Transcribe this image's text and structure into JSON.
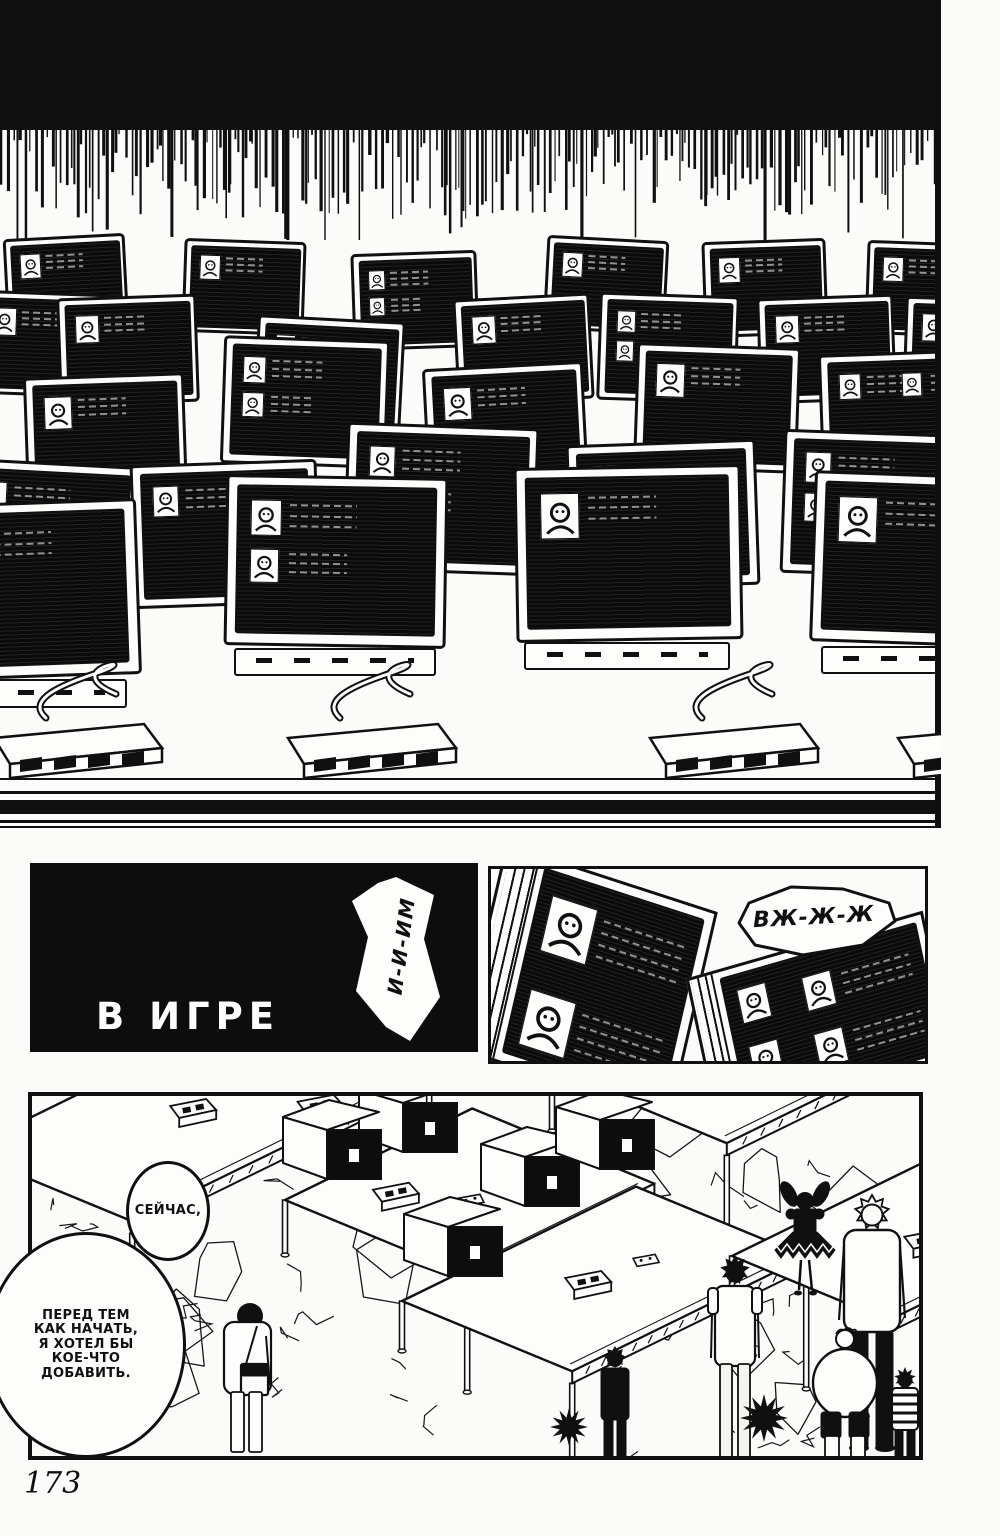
{
  "page": {
    "number": "173",
    "paper": "#fbfbf9",
    "ink": "#101010"
  },
  "texts": {
    "caption": "В ИГРЕ",
    "sfx_vertical": "И-И-ИМ",
    "sfx_whirr": "ВЖ-Ж-Ж",
    "bubble_now": "СЕЙЧАС,",
    "bubble_before_lines": [
      "ПЕРЕД ТЕМ",
      "КАК НАЧАТЬ,",
      "Я ХОТЕЛ БЫ",
      "КОЕ-ЧТО",
      "ДОБАВИТЬ."
    ]
  },
  "artwork": {
    "speedlines": {
      "width": 941,
      "solid_height": 130,
      "seed": 7
    },
    "wall": {
      "width": 941,
      "height": 835,
      "monitor_w": 218,
      "monitor_h": 168,
      "monitors": [
        [
          5,
          236,
          0.56,
          -3,
          1
        ],
        [
          183,
          240,
          0.56,
          2,
          1
        ],
        [
          352,
          252,
          0.58,
          -2,
          2
        ],
        [
          545,
          238,
          0.56,
          3,
          1
        ],
        [
          703,
          240,
          0.57,
          -2,
          1
        ],
        [
          866,
          242,
          0.56,
          2,
          1
        ],
        [
          -25,
          292,
          0.62,
          2,
          1
        ],
        [
          58,
          296,
          0.64,
          -2,
          1
        ],
        [
          255,
          318,
          0.68,
          3,
          2
        ],
        [
          455,
          296,
          0.63,
          -3,
          1
        ],
        [
          598,
          294,
          0.64,
          2,
          2
        ],
        [
          758,
          296,
          0.63,
          -2,
          1
        ],
        [
          904,
          298,
          0.62,
          2,
          1
        ],
        [
          25,
          375,
          0.74,
          -2,
          1
        ],
        [
          222,
          338,
          0.76,
          2,
          2
        ],
        [
          425,
          365,
          0.74,
          -3,
          1
        ],
        [
          635,
          345,
          0.75,
          2,
          1
        ],
        [
          820,
          352,
          0.74,
          -2,
          2
        ],
        [
          -50,
          462,
          0.86,
          3,
          1
        ],
        [
          132,
          462,
          0.86,
          -2,
          2
        ],
        [
          345,
          425,
          0.88,
          2,
          2
        ],
        [
          568,
          442,
          0.87,
          -2,
          1
        ],
        [
          782,
          432,
          0.86,
          2,
          2
        ],
        [
          -90,
          502,
          1.05,
          -2,
          1
        ],
        [
          225,
          476,
          1.02,
          1,
          2
        ],
        [
          515,
          466,
          1.04,
          -1,
          1
        ],
        [
          812,
          474,
          1.02,
          2,
          1
        ]
      ],
      "front_start": 23,
      "switch_boxes": [
        -6,
        288,
        650,
        898
      ],
      "edge_lines": [
        [
          778,
          2
        ],
        [
          791,
          3
        ],
        [
          800,
          14
        ],
        [
          820,
          3
        ],
        [
          826,
          2
        ]
      ],
      "right_rule": {
        "x": 935,
        "w": 6,
        "h": 828
      }
    },
    "panels": {
      "title": {
        "x": 30,
        "y": 863,
        "w": 448,
        "h": 189
      },
      "closeup": {
        "x": 488,
        "y": 866,
        "w": 440,
        "h": 198
      },
      "hall": {
        "x": 28,
        "y": 1092,
        "w": 895,
        "h": 368,
        "border": 4
      }
    },
    "hall": {
      "seed": 11,
      "cracks": 58,
      "stones": 16,
      "u": [
        0.9,
        -0.44
      ],
      "v": [
        0.92,
        0.38
      ],
      "tables": [
        {
          "o": [
            -70,
            55
          ],
          "L": 330,
          "S": 185,
          "legs": [
            60,
            115,
            140
          ],
          "items": [
            [
              "con",
              170,
              60
            ],
            [
              "pad",
              235,
              40
            ],
            [
              "con",
              240,
              130
            ]
          ]
        },
        {
          "o": [
            520,
            -25
          ],
          "L": 300,
          "S": 190,
          "legs": [
            60,
            130,
            150
          ],
          "items": [
            [
              "con",
              140,
              80
            ],
            [
              "pad",
              200,
              60
            ]
          ]
        },
        {
          "o": [
            253,
            104
          ],
          "L": 208,
          "S": 198,
          "legs": [
            55,
            105,
            125
          ],
          "items": [
            [
              "con",
              66,
              31
            ],
            [
              "pad",
              95,
              95
            ]
          ]
        },
        {
          "o": [
            370,
            205
          ],
          "L": 260,
          "S": 185,
          "legs": [
            50,
            100,
            120
          ],
          "items": [
            [
              "con",
              120,
              60
            ],
            [
              "pad",
              175,
              80
            ]
          ]
        },
        {
          "o": [
            700,
            160
          ],
          "L": 240,
          "S": 170,
          "legs": [
            45,
            95,
            115
          ],
          "items": [
            [
              "con",
              120,
              70
            ]
          ]
        }
      ],
      "monitors": [
        [
          327,
          -6
        ],
        [
          251,
          21
        ],
        [
          449,
          48
        ],
        [
          524,
          11
        ],
        [
          372,
          118
        ]
      ],
      "people": [
        {
          "type": "girl",
          "x": 773,
          "feet": 200,
          "h": 112
        },
        {
          "type": "tallman",
          "x": 840,
          "feet": 354,
          "h": 250
        },
        {
          "type": "boy",
          "x": 703,
          "feet": 366,
          "h": 204
        },
        {
          "type": "darkkid",
          "x": 583,
          "feet": 366,
          "h": 114
        },
        {
          "type": "walker",
          "x": 216,
          "feet": 356,
          "h": 150
        },
        {
          "type": "heavykid",
          "x": 813,
          "feet": 366,
          "h": 134
        },
        {
          "type": "stripedkid",
          "x": 873,
          "feet": 364,
          "h": 92
        },
        {
          "type": "spikeball",
          "x": 732,
          "feet": 346,
          "h": 48
        },
        {
          "type": "spikeball",
          "x": 537,
          "feet": 350,
          "h": 38
        }
      ]
    },
    "bubbles": {
      "now": {
        "x": 126,
        "y": 1161,
        "w": 84,
        "h": 100
      },
      "before": {
        "x": -14,
        "y": 1232,
        "w": 200,
        "h": 226
      }
    }
  }
}
